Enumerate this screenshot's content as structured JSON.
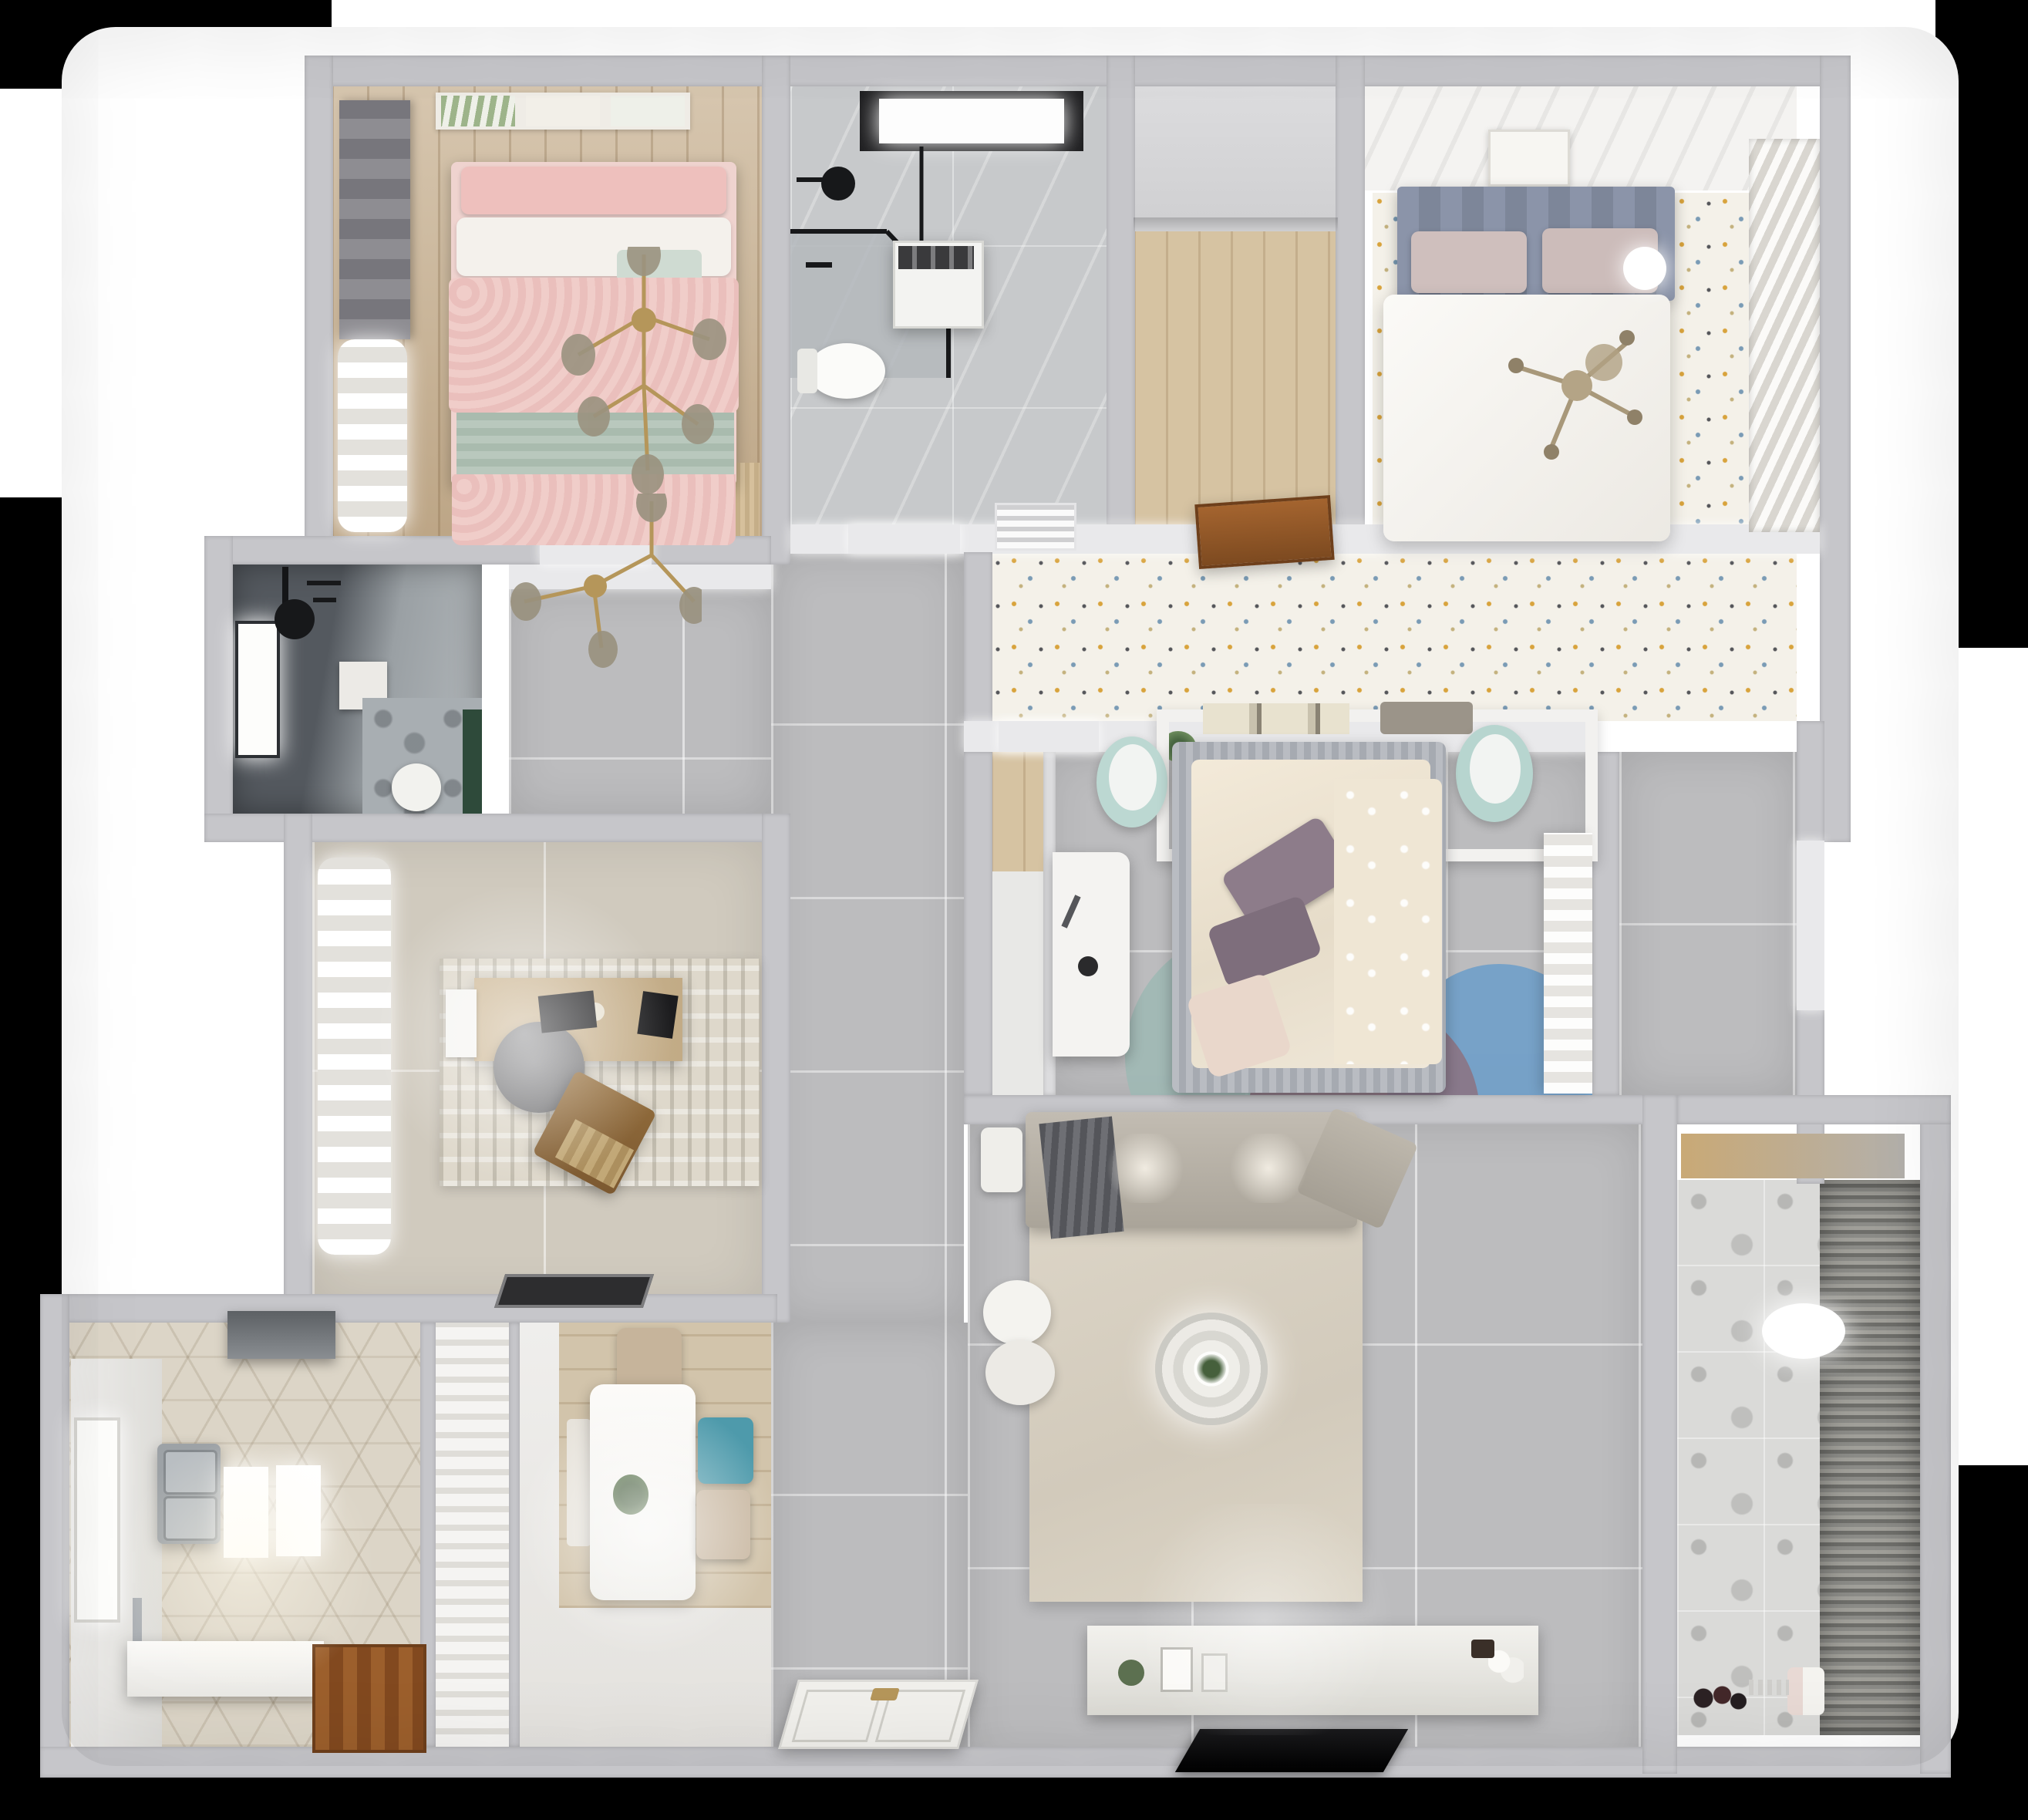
{
  "scene": {
    "kind": "3d-floorplan-top-down-render",
    "visible_text": "none",
    "background_color": "#000000",
    "matte_color": "#ffffff"
  },
  "palette": {
    "wall_gray": "#c6c6ca",
    "wall_lit": "#e9e9eb",
    "tile_gray_floor": "#bcbcbe",
    "tile_beige_floor": "#d0cabe",
    "marble_floor": "#c7c9cb",
    "wood_tan": "#c9b394",
    "wood_light": "#d6c3a2",
    "speckled_floor": "#f4f1e9",
    "hex_tile": "#dcd5c7",
    "cement_tile": "#dadad8",
    "pink_bedding": "#eec9c6",
    "sage_throw": "#b9c8bd",
    "white_bedding": "#f6f4f0",
    "headboard_blue_gray": "#8b94a9",
    "mauve_pillow": "#cdbcba",
    "purple_pillow": "#8d7c8a",
    "mint_pouf": "#bcd8d2",
    "teal_chair": "#4e9aab",
    "sofa_gray": "#b7b0a7",
    "rug_beige": "#d9d2c4",
    "gold_accent": "#b5965a",
    "door_brown": "#94562a",
    "dark_bath_wall": "#585d63",
    "green_accent": "#2e4a3a",
    "tv_black": "#141414"
  },
  "rooms": [
    {
      "name": "bedroom-pink",
      "floor": "wood_tan"
    },
    {
      "name": "bathroom-ensuite",
      "floor": "marble"
    },
    {
      "name": "walk-in-closet",
      "floor": "wood_light"
    },
    {
      "name": "master-bedroom",
      "floor": "speckled"
    },
    {
      "name": "bathroom-guest",
      "floor": "dark_tile"
    },
    {
      "name": "study",
      "floor": "tile_beige"
    },
    {
      "name": "kids-bedroom",
      "floor": "tile_gray"
    },
    {
      "name": "kitchen",
      "floor": "hex_tile"
    },
    {
      "name": "dining",
      "floor": "wood_plank"
    },
    {
      "name": "living-room",
      "floor": "tile_gray"
    },
    {
      "name": "balcony-laundry",
      "floor": "cement_tile"
    },
    {
      "name": "hallway",
      "floor": "tile_gray"
    }
  ],
  "furniture": [
    "double-bed-pink",
    "double-bed-white",
    "double-bed-kids",
    "branch-chandelier-gold",
    "cross-chandelier-gold",
    "roman-blind",
    "sheer-curtain",
    "corner-shower",
    "washing-machine",
    "toilet",
    "wardrobe-louvered",
    "headboard-shelf",
    "mint-pouf",
    "writing-desk",
    "office-chair",
    "lounge-chair",
    "area-rug",
    "door-mat",
    "range-hood",
    "double-sink",
    "kitchen-island",
    "dining-table",
    "dining-chair",
    "pendant-lamp-rings",
    "sectional-sofa",
    "ottoman",
    "ceiling-lamp-rings",
    "media-console",
    "tv-flatscreen",
    "entry-double-door",
    "open-door-leaf",
    "ac-vent",
    "venetian-blinds",
    "potted-plant",
    "wall-art-frames",
    "window"
  ]
}
